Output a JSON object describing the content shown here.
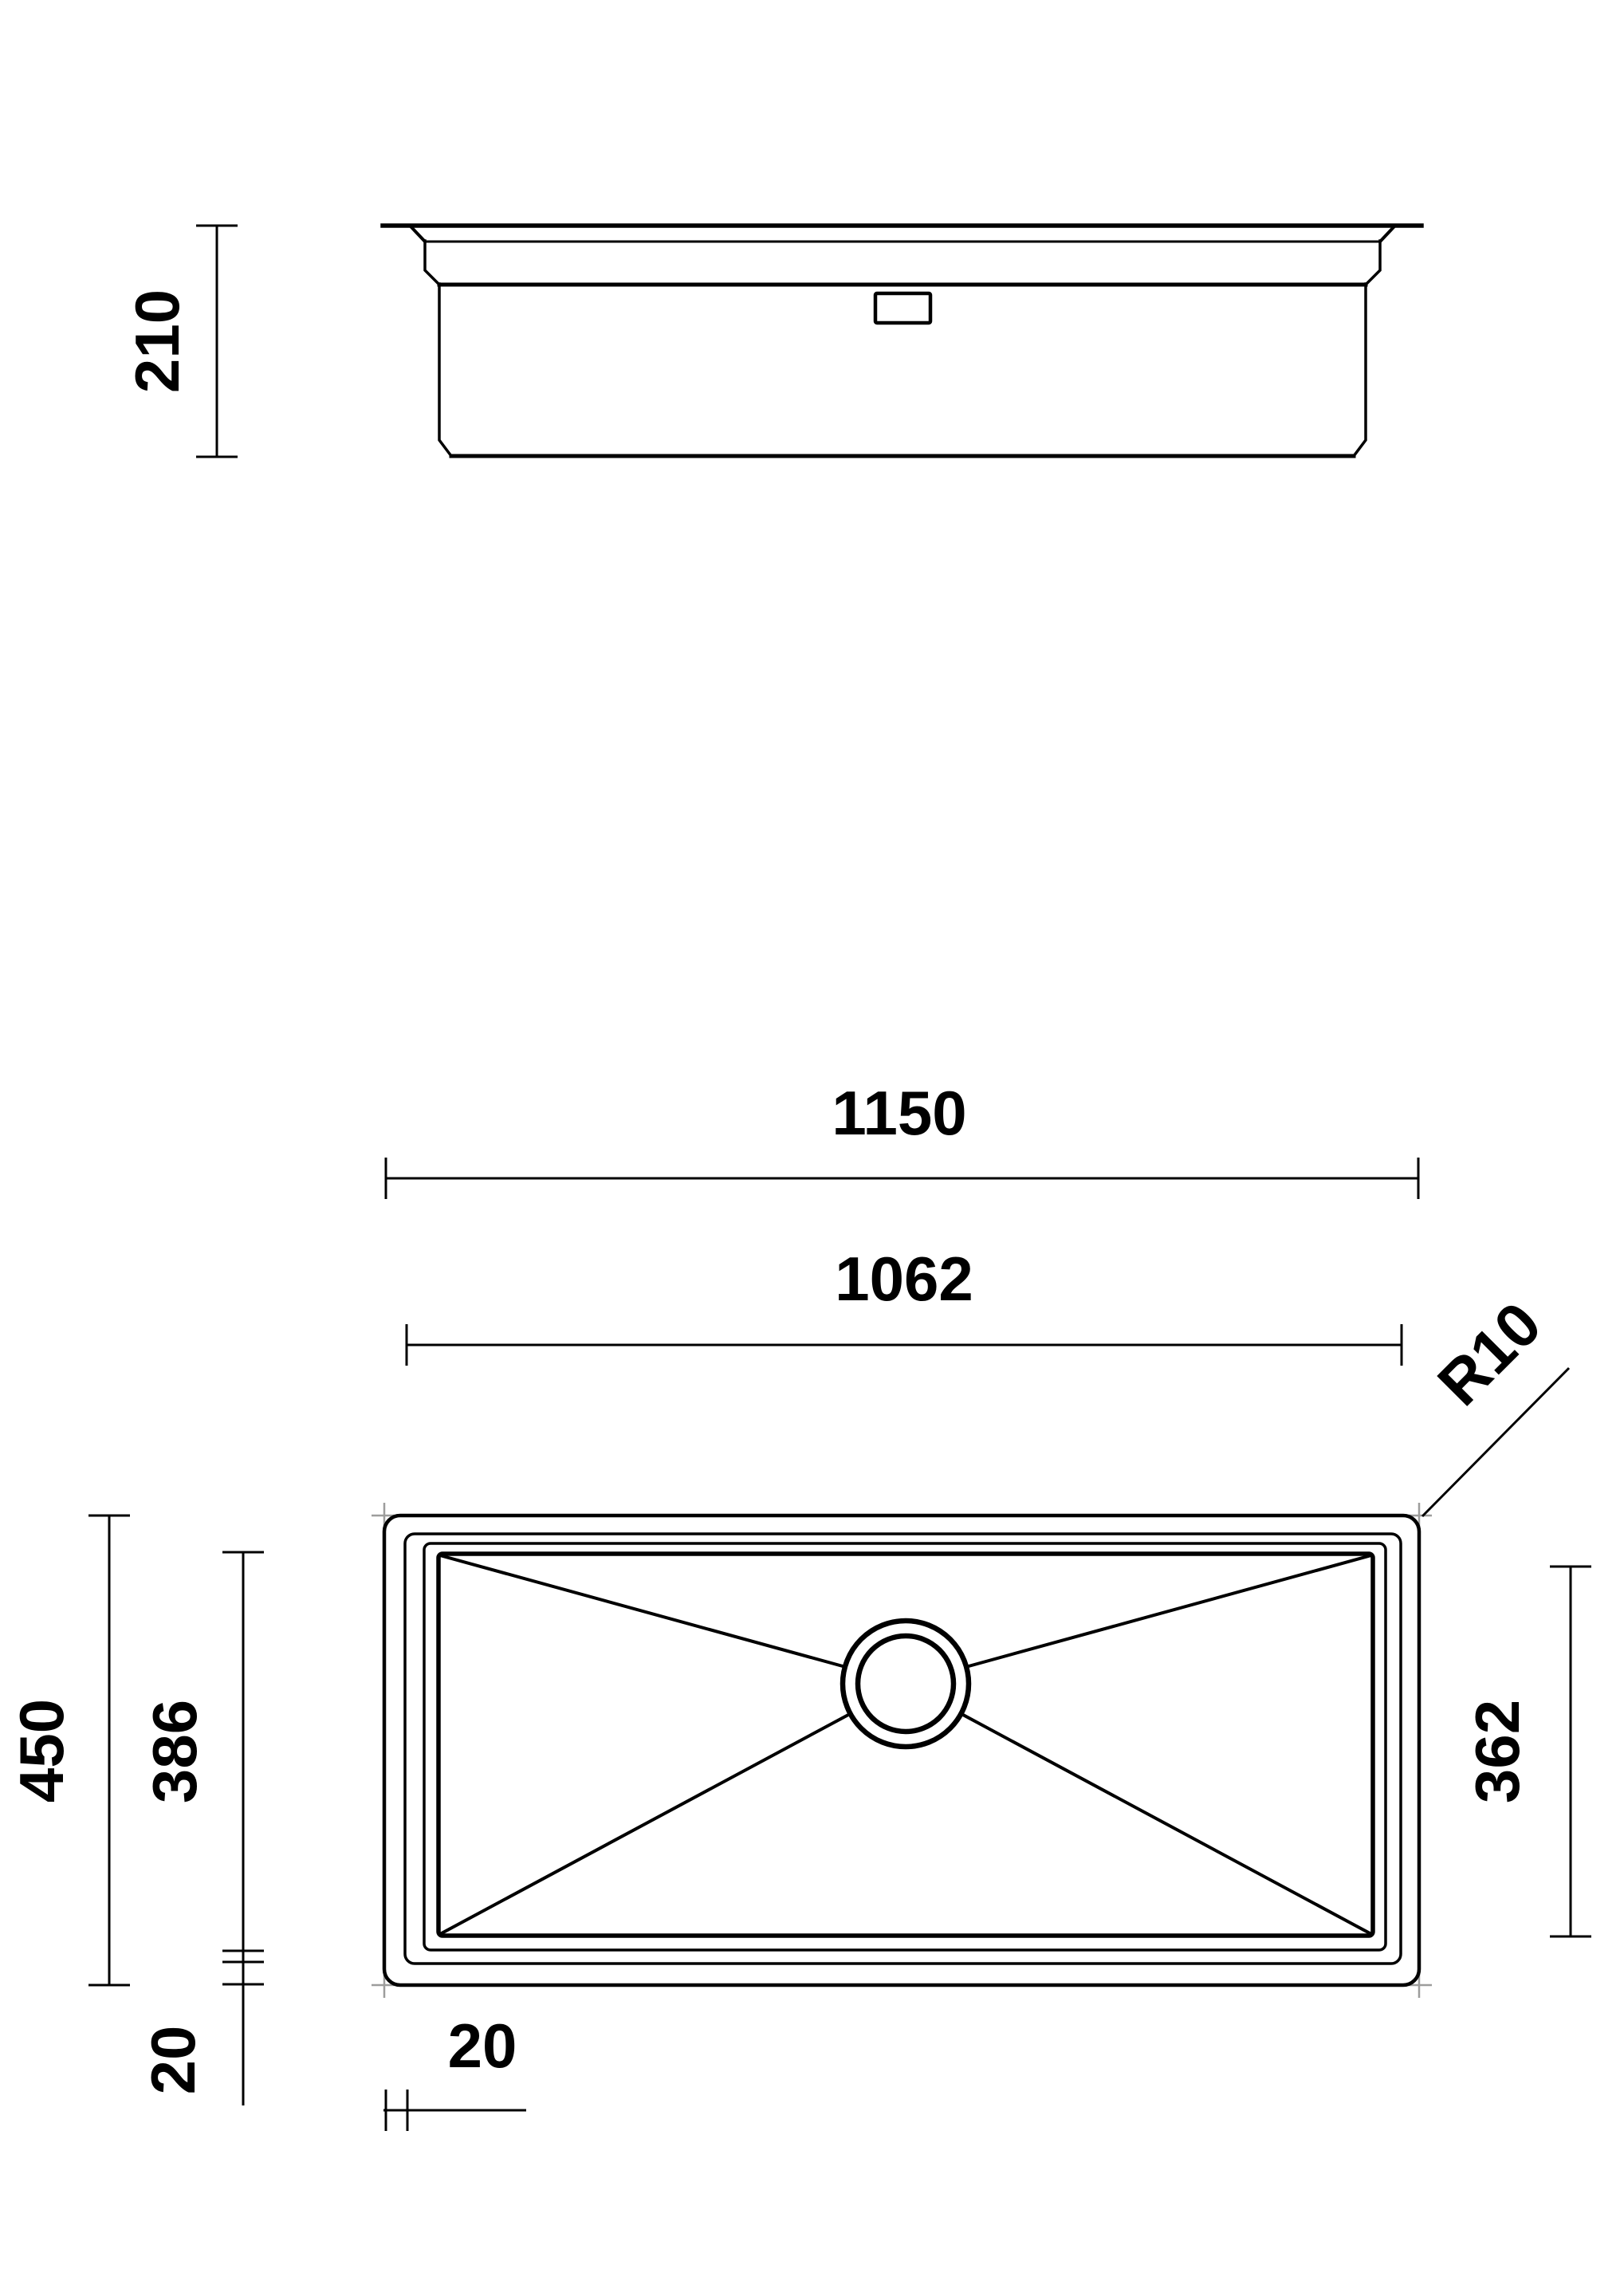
{
  "drawing": {
    "type": "sink technical drawing",
    "colors": {
      "line": "#000000",
      "marker": "#9d9d9c",
      "background": "#ffffff"
    },
    "side_view": {
      "name": "side elevation",
      "depth_dim": "210"
    },
    "plan_view": {
      "name": "plan view",
      "overall_width_dim": "1150",
      "flange_width_dim": "1062",
      "corner_radius_label": "R10",
      "overall_depth_dim": "450",
      "bowl_depth_dim": "386",
      "bowl_inner_depth_dim": "362",
      "rim_depth_dim": "20",
      "rim_width_dim": "20"
    }
  }
}
